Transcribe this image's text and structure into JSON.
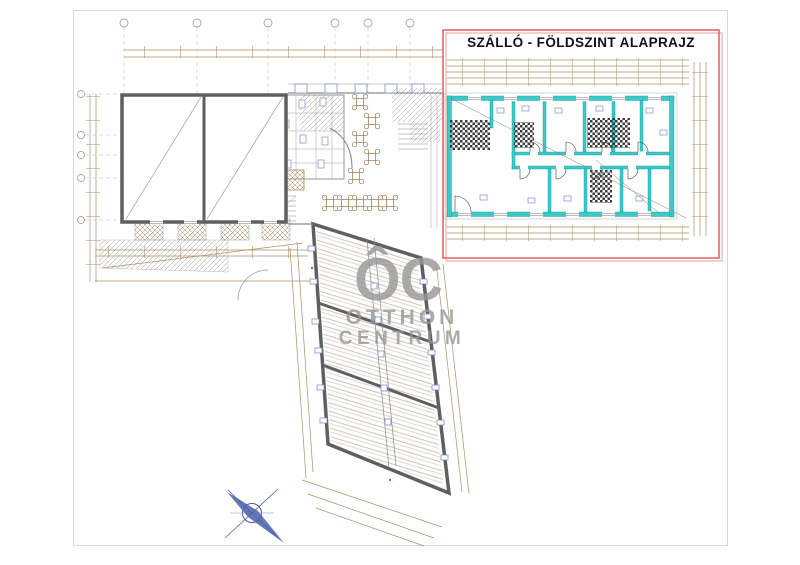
{
  "title": {
    "text": "SZÁLLÓ - FÖLDSZINT ALAPRAJZ"
  },
  "watermark": {
    "monogram": "ÔC",
    "line1": "OTTHON",
    "line2": "CENTRUM"
  },
  "colors": {
    "highlight_red": "#e25353",
    "highlight_red_shadow": "#f2b9b9",
    "teal_wall": "#3cc9c7",
    "teal_edge": "#0e9c9a",
    "dimension_sepia": "#ae8e66",
    "wall_gray": "#5f5f5f",
    "line_gray": "#9a9a9a",
    "detail_blue": "#8092c8",
    "watermark_gray": "#979797",
    "compass_blue": "#4c5ea8",
    "paper_frame": "#d9d9d9",
    "title_black": "#111111"
  }
}
